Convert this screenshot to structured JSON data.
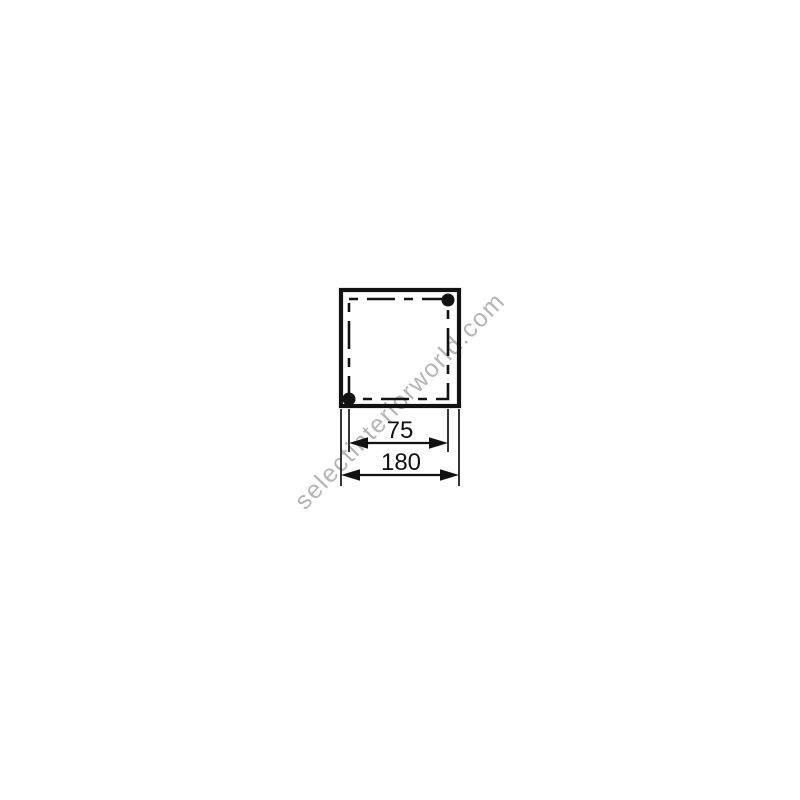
{
  "page": {
    "background": "#ffffff"
  },
  "diagram": {
    "colors": {
      "line": "#121212",
      "watermark": "#b5b5b5"
    },
    "dimensions": [
      {
        "name": "hole-spacing",
        "value": "75"
      },
      {
        "name": "overall-width",
        "value": "180"
      }
    ]
  },
  "watermark": {
    "text": "selectinteriorworld.com"
  }
}
